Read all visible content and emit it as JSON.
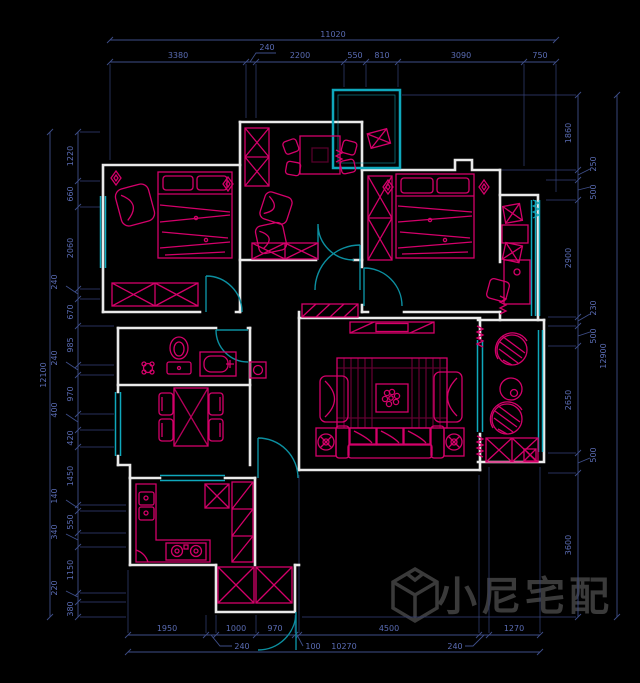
{
  "watermark": {
    "logo": "cube-logo",
    "text": "小尼宅配"
  },
  "colors": {
    "background": "#000000",
    "dimension_line": "#3e4e88",
    "dimension_text": "#5a6cb4",
    "wall": "#e9e9e9",
    "furniture_magenta": "#d4006a",
    "window_cyan": "#0fa8bc",
    "door_teal": "#0c8fa0",
    "watermark_gray": "#3a3a3a"
  },
  "dims": {
    "top": {
      "overall": "11020",
      "segments": [
        "3380",
        "240",
        "2200",
        "550",
        "810",
        "3090",
        "750"
      ]
    },
    "left": {
      "overall": "12100",
      "segments": [
        "1220",
        "660",
        "2060",
        "240",
        "670",
        "985",
        "240",
        "970",
        "400",
        "420",
        "1450",
        "140",
        "550",
        "340",
        "1150",
        "220",
        "380"
      ]
    },
    "right": {
      "overall": "12900",
      "segments": [
        "1860",
        "250",
        "500",
        "2900",
        "230",
        "500",
        "2650",
        "500",
        "3600"
      ]
    },
    "bottom": {
      "overall": "10270",
      "segments": [
        "1950",
        "240",
        "1000",
        "970",
        "100",
        "4500",
        "240",
        "1270"
      ]
    }
  }
}
